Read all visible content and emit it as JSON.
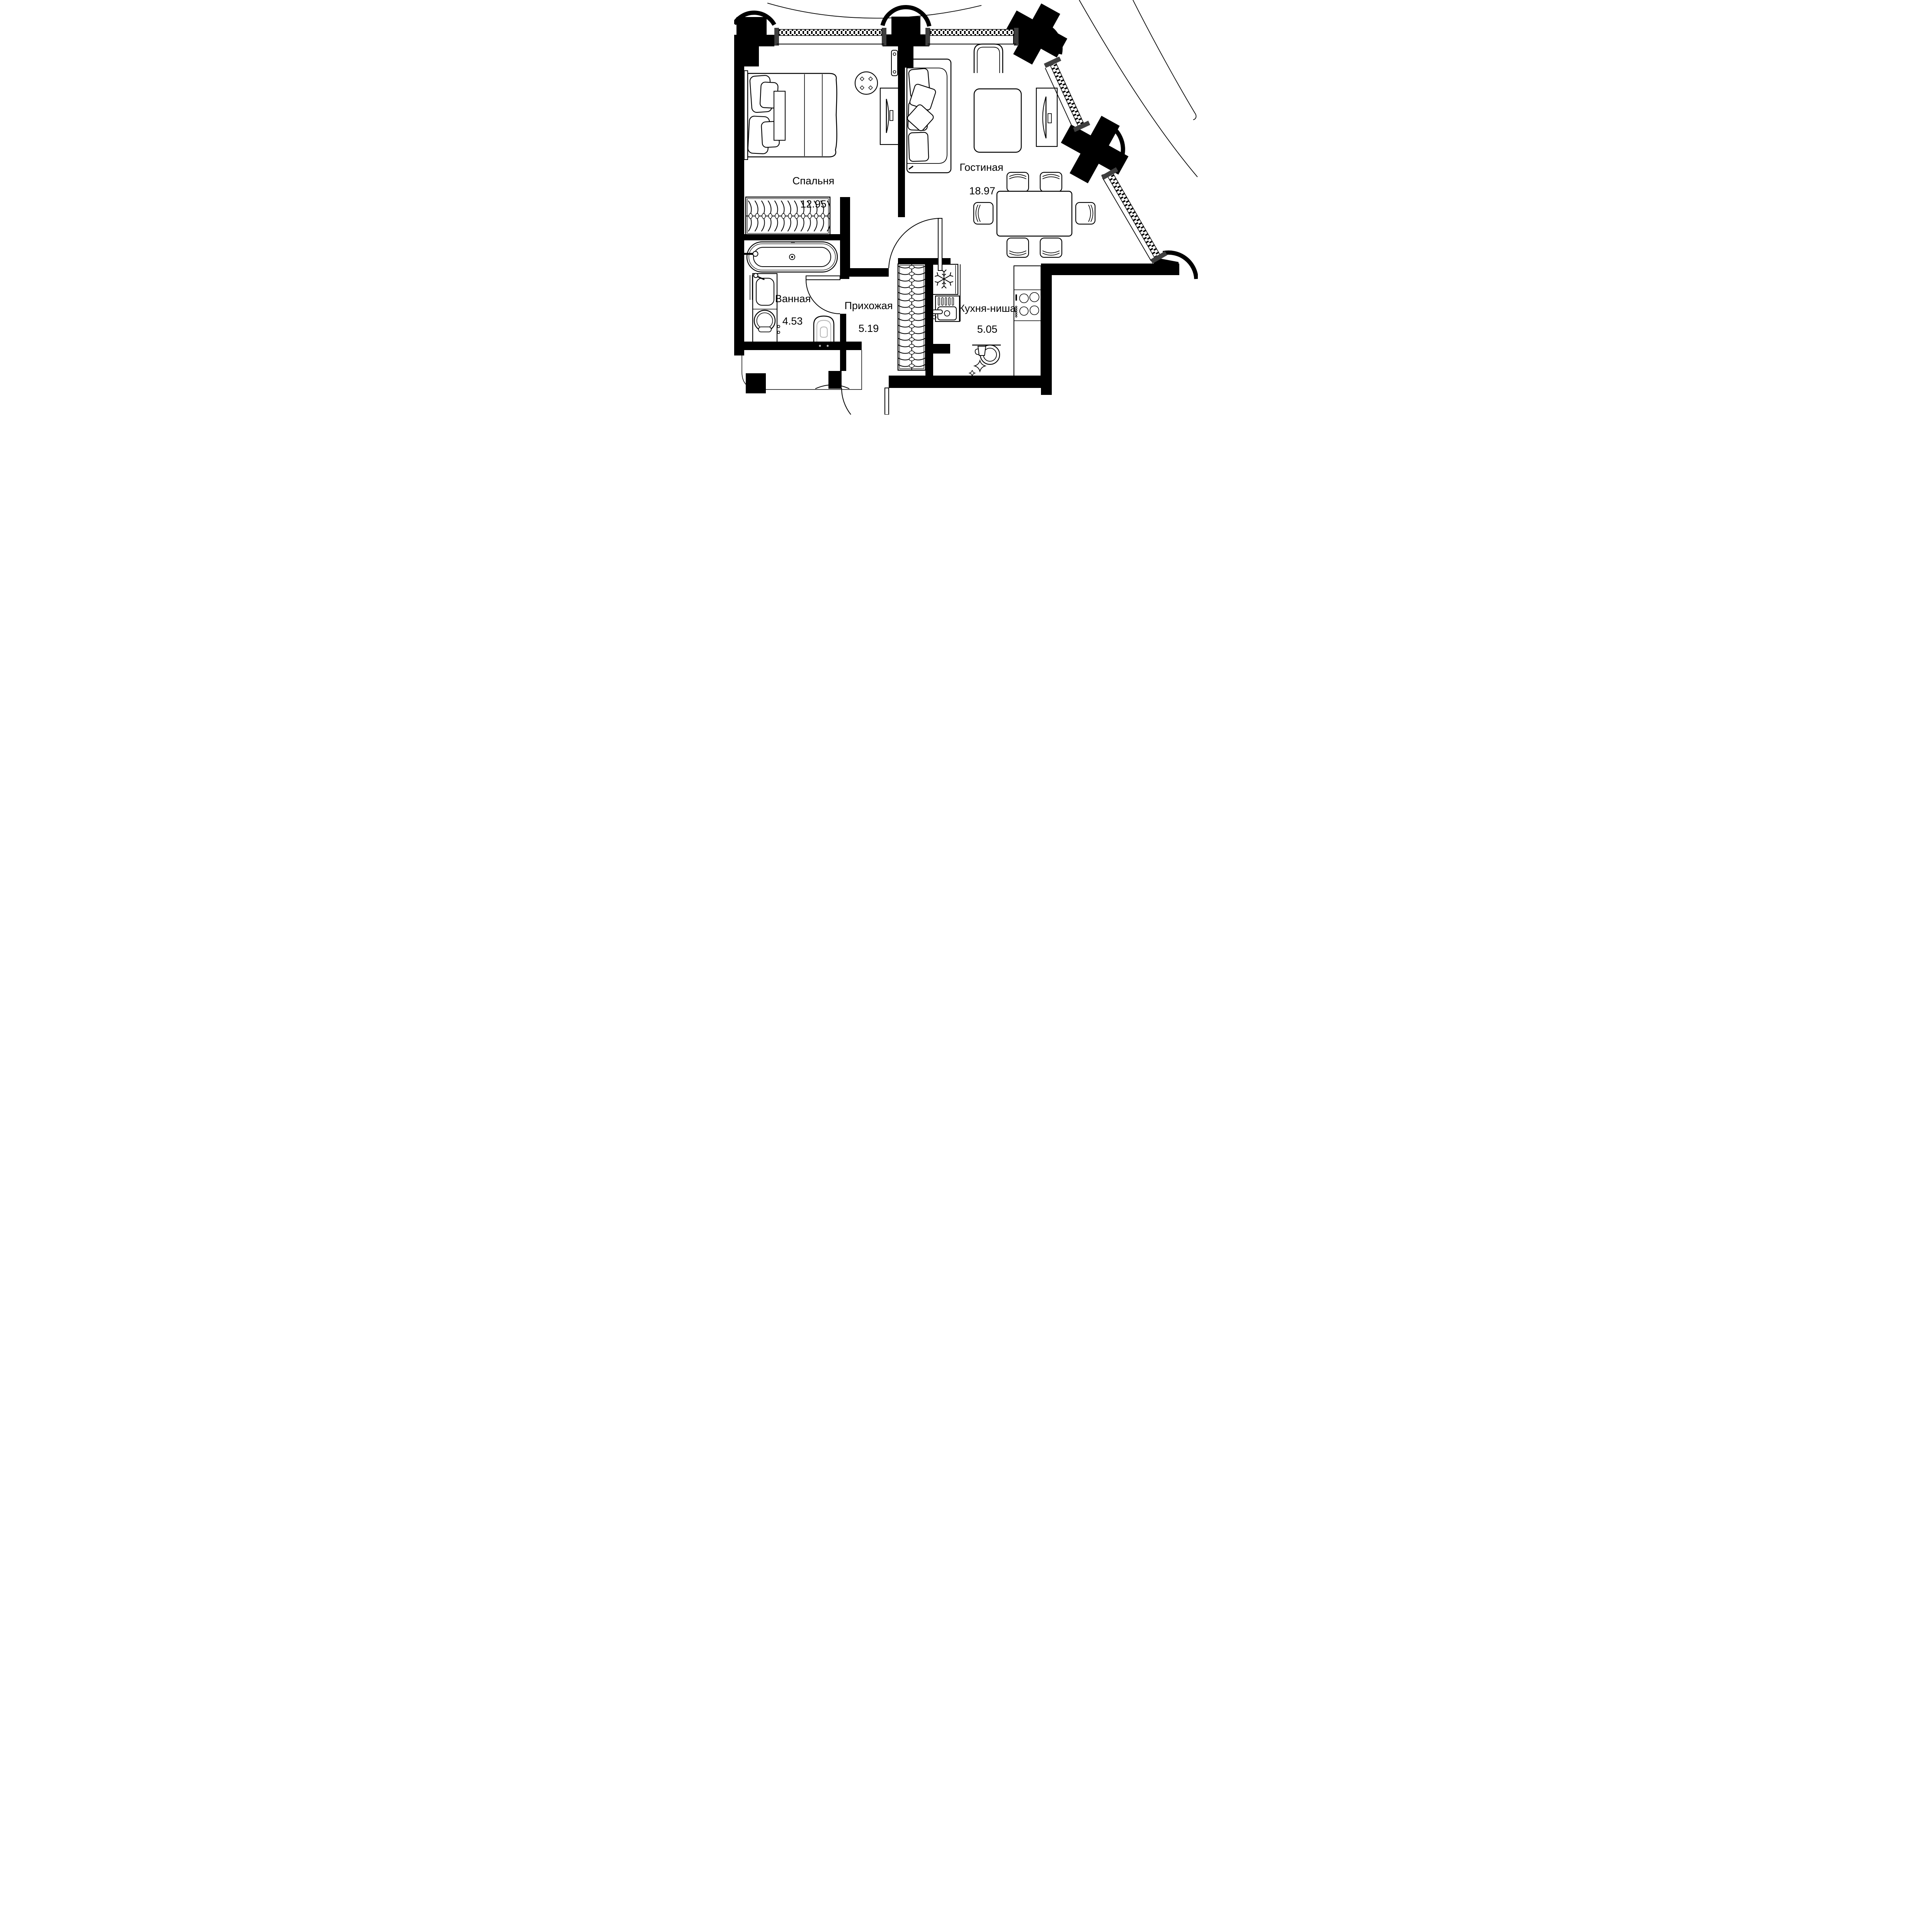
{
  "floor_plan": {
    "type": "apartment-floor-plan",
    "rooms": [
      {
        "id": "bedroom",
        "name": "Спальня",
        "area": "12.95"
      },
      {
        "id": "living_room",
        "name": "Гостиная",
        "area": "18.97"
      },
      {
        "id": "bathroom",
        "name": "Ванная",
        "area": "4.53"
      },
      {
        "id": "hallway",
        "name": "Прихожая",
        "area": "5.19"
      },
      {
        "id": "kitchen_niche",
        "name": "Кухня-ниша",
        "area": "5.05"
      }
    ],
    "colors": {
      "wall": "#000000",
      "window_jamb": "#3f3f3f",
      "background": "#ffffff",
      "fixture_accent": "#b9b9b9"
    }
  }
}
